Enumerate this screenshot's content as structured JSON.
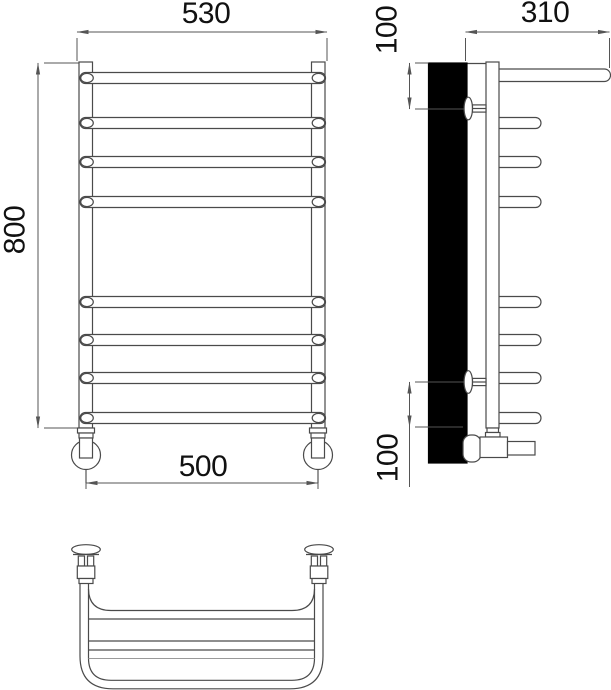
{
  "drawing": {
    "description": "Three-view technical drawing of a ladder towel rail (front, side, top views)",
    "rung_count": 8
  },
  "dims": {
    "front": {
      "top_width": "530",
      "height": "800",
      "bottom_width": "500"
    },
    "side": {
      "depth": "310",
      "top_offset": "100",
      "bottom_offset": "100"
    }
  },
  "colors": {
    "line": "#4a4a4a",
    "dim_line": "#555555",
    "text": "#111111",
    "wall_fill": "#000000",
    "background": "#ffffff",
    "light_line": "#9a9a9a"
  }
}
